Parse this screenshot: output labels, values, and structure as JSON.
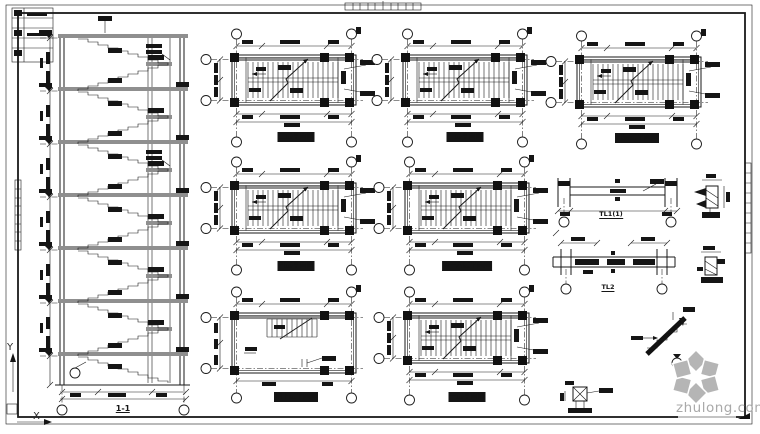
{
  "colors": {
    "background": "#ffffff",
    "line": "#1a1a1a",
    "slab_gray": "#8f8f8f",
    "watermark_logo": "#b5b5b5",
    "watermark_text": "#a9a9a9"
  },
  "section": {
    "title": "1-1"
  },
  "plans": [
    {
      "title": "二层平面图"
    },
    {
      "title": "三层平面图"
    },
    {
      "title": "机房层平面图"
    },
    {
      "title": "四层平面图"
    },
    {
      "title": "五~六层平面图"
    },
    {
      "title": "地下层平面图"
    },
    {
      "title": "一层平面图"
    }
  ],
  "beams": [
    {
      "title": "TL1(1)"
    },
    {
      "title": "TL2"
    }
  ],
  "ucs": {
    "x": "X",
    "y": "Y"
  },
  "watermark": {
    "text": "zhulong.com"
  }
}
